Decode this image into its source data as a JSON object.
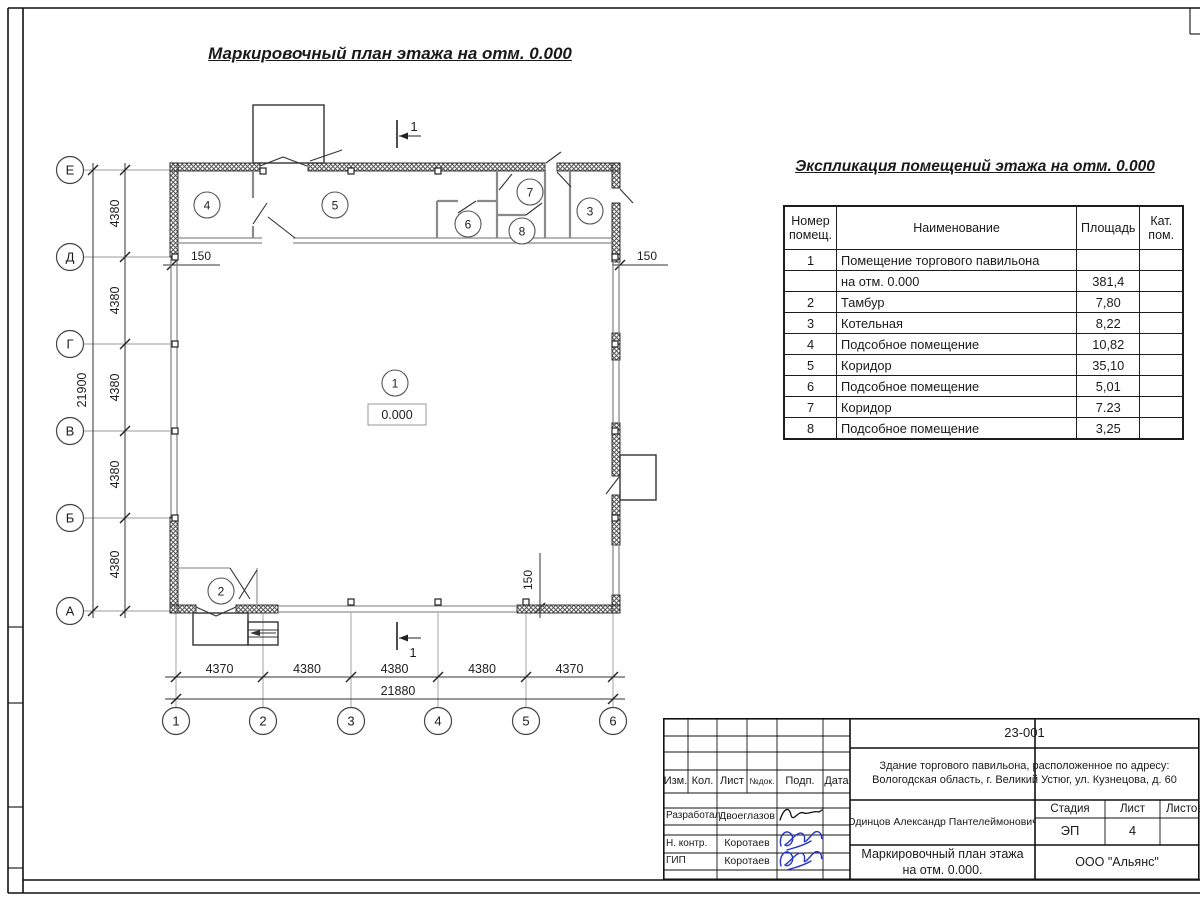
{
  "sheet": {
    "plan_title": "Маркировочный план этажа на отм. 0.000",
    "colors": {
      "signature_blue": "#2336c9",
      "line": "#1d1d1d"
    }
  },
  "plan": {
    "row_axes": [
      "Е",
      "Д",
      "Г",
      "В",
      "Б",
      "А"
    ],
    "col_axes": [
      "1",
      "2",
      "3",
      "4",
      "5",
      "6"
    ],
    "left_dims": [
      "4380",
      "4380",
      "4380",
      "4380",
      "4380"
    ],
    "left_total": "21900",
    "bottom_dims": [
      "4370",
      "4380",
      "4380",
      "4380",
      "4370"
    ],
    "bottom_total": "21880",
    "offset_left": "150",
    "offset_right": "150",
    "offset_bottom": "150",
    "elevation": "0.000",
    "section_label": "1",
    "rooms": [
      "1",
      "2",
      "3",
      "4",
      "5",
      "6",
      "7",
      "8"
    ]
  },
  "explication": {
    "title": "Экспликация помещений этажа на отм. 0.000",
    "headers": {
      "num_l1": "Номер",
      "num_l2": "помещ.",
      "name": "Наименование",
      "area": "Площадь",
      "cat_l1": "Кат.",
      "cat_l2": "пом."
    },
    "rows": [
      {
        "num": "1",
        "name": "Помещение торгового павильона",
        "area": "",
        "cat": ""
      },
      {
        "num": "",
        "name": "на отм. 0.000",
        "area": "381,4",
        "cat": ""
      },
      {
        "num": "2",
        "name": "Тамбур",
        "area": "7,80",
        "cat": ""
      },
      {
        "num": "3",
        "name": "Котельная",
        "area": "8,22",
        "cat": ""
      },
      {
        "num": "4",
        "name": "Подсобное помещение",
        "area": "10,82",
        "cat": ""
      },
      {
        "num": "5",
        "name": "Коридор",
        "area": "35,10",
        "cat": ""
      },
      {
        "num": "6",
        "name": "Подсобное помещение",
        "area": "5,01",
        "cat": ""
      },
      {
        "num": "7",
        "name": "Коридор",
        "area": "7.23",
        "cat": ""
      },
      {
        "num": "8",
        "name": "Подсобное помещение",
        "area": "3,25",
        "cat": ""
      }
    ]
  },
  "titleblock": {
    "doc_number": "23-001",
    "address_line1": "Здание торгового павильона, расположенное по адресу:",
    "address_line2": "Вологодская область, г. Великий Устюг, ул. Кузнецова, д. 60",
    "header_cells": [
      "Изм.",
      "Кол.",
      "Лист",
      "№док.",
      "Подп.",
      "Дата"
    ],
    "stage_label": "Стадия",
    "sheet_label": "Лист",
    "sheets_label": "Листов",
    "stage": "ЭП",
    "sheet_num": "4",
    "author_name": "Одинцов Александр Пантелеймонович",
    "drawing_title_line1": "Маркировочный план этажа",
    "drawing_title_line2": "на отм. 0.000.",
    "company": "ООО \"Альянс\"",
    "staff": [
      {
        "role": "Разработал",
        "name": "Двоеглазов"
      },
      {
        "role": "Н. контр.",
        "name": "Коротаев"
      },
      {
        "role": "ГИП",
        "name": "Коротаев"
      }
    ]
  }
}
